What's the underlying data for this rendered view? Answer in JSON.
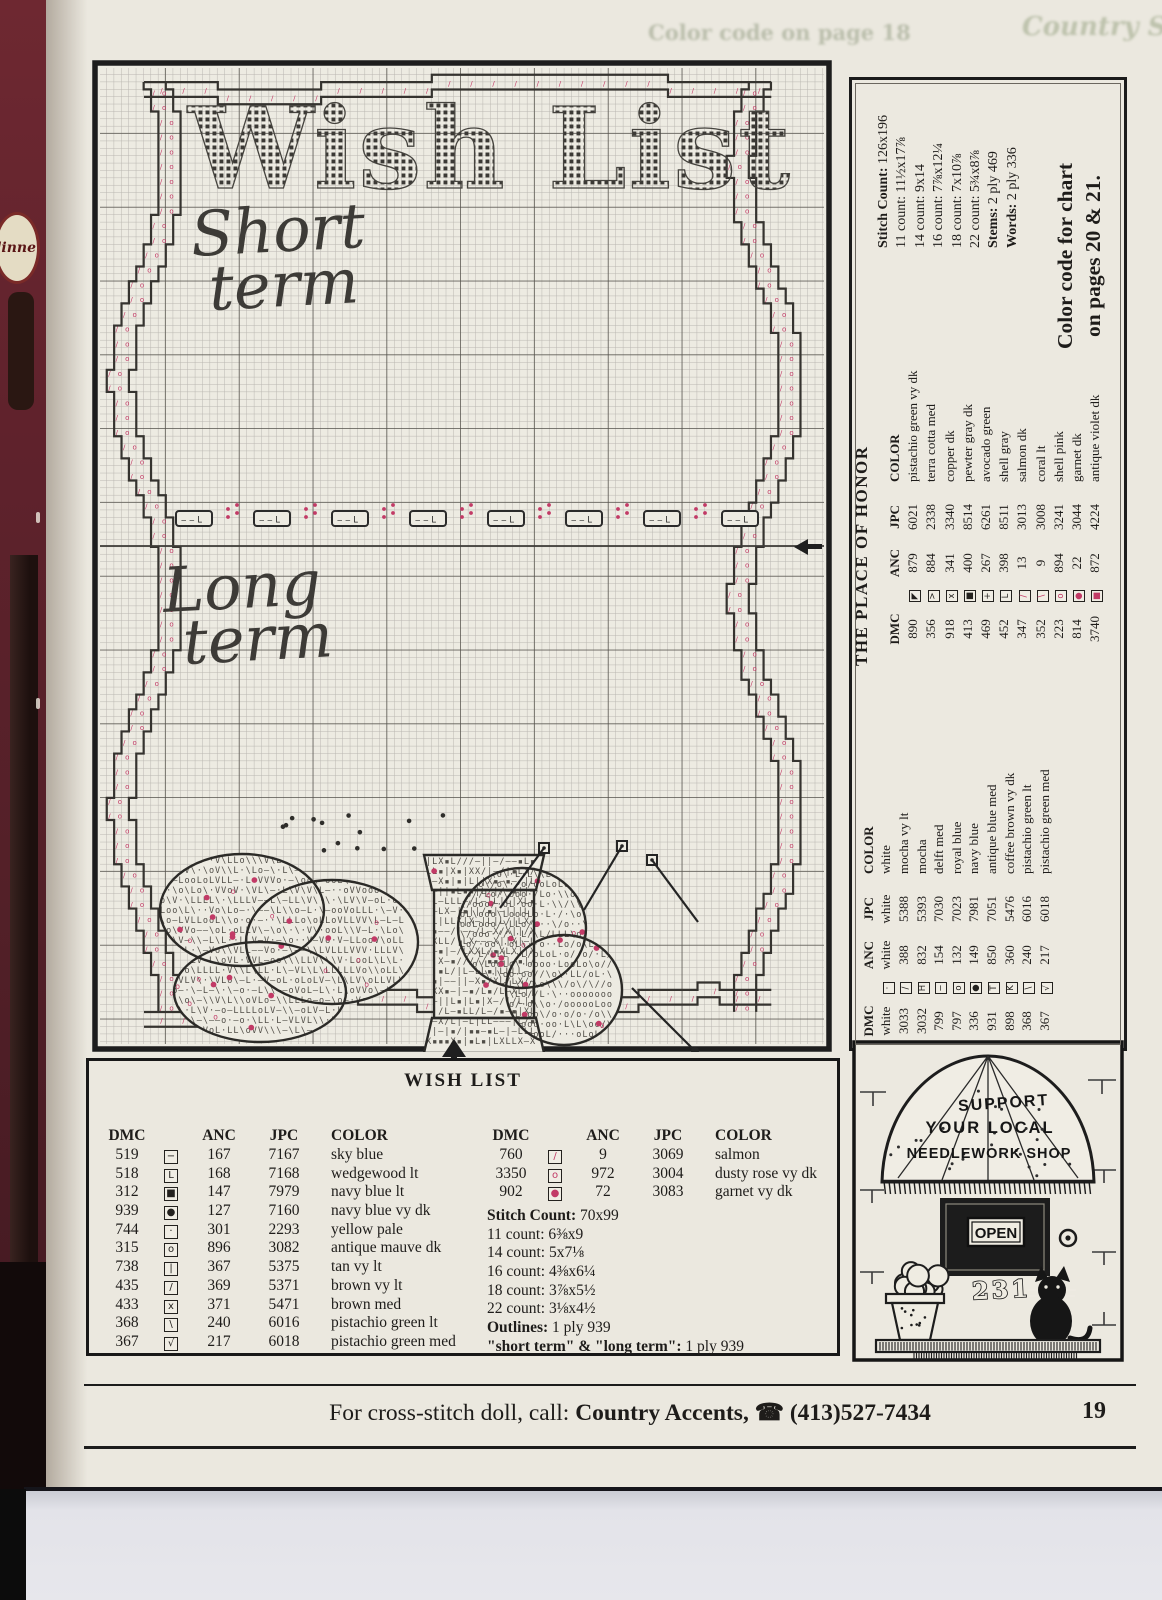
{
  "page": {
    "ghost_left": "Color code on page 18",
    "ghost_right": "Country Sampler",
    "footer": {
      "prefix": "For cross-stitch doll, call:",
      "brand": "Country Accents,",
      "phone_icon": "☎",
      "phone": "(413)527-7434",
      "page_number": "19"
    }
  },
  "side_photo": {
    "label": "dinne"
  },
  "chart": {
    "title": "Wish List",
    "short_line1": "Short",
    "short_line2": "term",
    "long_line1": "Long",
    "long_line2": "term"
  },
  "sidebar": {
    "title": "THE PLACE OF HONOR",
    "note_line1": "Color code for chart",
    "note_line2": "on pages 20 & 21.",
    "counts": [
      {
        "label": "Stitch Count:",
        "value": "126x196",
        "bold": true
      },
      {
        "label": "11 count:",
        "value": "11½x17⅞",
        "bold": false
      },
      {
        "label": "14 count:",
        "value": "9x14",
        "bold": false
      },
      {
        "label": "16 count:",
        "value": "7⅞x12¼",
        "bold": false
      },
      {
        "label": "18 count:",
        "value": "7x10⅞",
        "bold": false
      },
      {
        "label": "22 count:",
        "value": "5¾x8⅞",
        "bold": false
      },
      {
        "label": "Stems:",
        "value": "2 ply 469",
        "bold": true
      },
      {
        "label": "Words:",
        "value": "2 ply 336",
        "bold": true
      }
    ],
    "table1": {
      "headers": [
        "DMC",
        "ANC",
        "JPC",
        "COLOR"
      ],
      "rows": [
        {
          "dmc": "890",
          "sym": "◤",
          "pink": false,
          "anc": "879",
          "jpc": "6021",
          "color": "pistachio green vy dk"
        },
        {
          "dmc": "356",
          "sym": ">",
          "pink": false,
          "anc": "884",
          "jpc": "2338",
          "color": "terra cotta med"
        },
        {
          "dmc": "918",
          "sym": "x",
          "pink": false,
          "anc": "341",
          "jpc": "3340",
          "color": "copper dk"
        },
        {
          "dmc": "413",
          "sym": "■",
          "pink": false,
          "anc": "400",
          "jpc": "8514",
          "color": "pewter gray dk"
        },
        {
          "dmc": "469",
          "sym": "+",
          "pink": false,
          "anc": "267",
          "jpc": "6261",
          "color": "avocado green"
        },
        {
          "dmc": "452",
          "sym": "L",
          "pink": false,
          "anc": "398",
          "jpc": "8511",
          "color": "shell gray"
        },
        {
          "dmc": "347",
          "sym": "/",
          "pink": true,
          "anc": "13",
          "jpc": "3013",
          "color": "salmon dk"
        },
        {
          "dmc": "352",
          "sym": "\\",
          "pink": true,
          "anc": "9",
          "jpc": "3008",
          "color": "coral lt"
        },
        {
          "dmc": "223",
          "sym": "o",
          "pink": true,
          "anc": "894",
          "jpc": "3241",
          "color": "shell pink"
        },
        {
          "dmc": "814",
          "sym": "●",
          "pink": true,
          "anc": "22",
          "jpc": "3044",
          "color": "garnet dk"
        },
        {
          "dmc": "3740",
          "sym": "■",
          "pink": true,
          "anc": "872",
          "jpc": "4224",
          "color": "antique violet dk"
        }
      ]
    },
    "table2": {
      "headers": [
        "DMC",
        "ANC",
        "JPC",
        "COLOR"
      ],
      "rows": [
        {
          "dmc": "white",
          "sym": "·",
          "pink": false,
          "anc": "white",
          "jpc": "white",
          "color": "white"
        },
        {
          "dmc": "3033",
          "sym": "/",
          "pink": false,
          "anc": "388",
          "jpc": "5388",
          "color": "mocha vy lt"
        },
        {
          "dmc": "3032",
          "sym": "H",
          "pink": false,
          "anc": "832",
          "jpc": "5393",
          "color": "mocha"
        },
        {
          "dmc": "799",
          "sym": "−",
          "pink": false,
          "anc": "154",
          "jpc": "7030",
          "color": "delft med"
        },
        {
          "dmc": "797",
          "sym": "o",
          "pink": false,
          "anc": "132",
          "jpc": "7023",
          "color": "royal blue"
        },
        {
          "dmc": "336",
          "sym": "●",
          "pink": false,
          "anc": "149",
          "jpc": "7981",
          "color": "navy blue"
        },
        {
          "dmc": "931",
          "sym": "T",
          "pink": false,
          "anc": "850",
          "jpc": "7051",
          "color": "antique blue med"
        },
        {
          "dmc": "898",
          "sym": "K",
          "pink": false,
          "anc": "360",
          "jpc": "5476",
          "color": "coffee brown vy dk"
        },
        {
          "dmc": "368",
          "sym": "\\",
          "pink": false,
          "anc": "240",
          "jpc": "6016",
          "color": "pistachio green lt"
        },
        {
          "dmc": "367",
          "sym": "√",
          "pink": false,
          "anc": "217",
          "jpc": "6018",
          "color": "pistachio green med"
        }
      ]
    }
  },
  "wish_list_key": {
    "title": "WISH LIST",
    "left": {
      "headers": [
        "DMC",
        "ANC",
        "JPC",
        "COLOR"
      ],
      "rows": [
        {
          "dmc": "519",
          "sym": "−",
          "pink": false,
          "anc": "167",
          "jpc": "7167",
          "color": "sky blue"
        },
        {
          "dmc": "518",
          "sym": "L",
          "pink": false,
          "anc": "168",
          "jpc": "7168",
          "color": "wedgewood lt"
        },
        {
          "dmc": "312",
          "sym": "■",
          "pink": false,
          "anc": "147",
          "jpc": "7979",
          "color": "navy blue lt"
        },
        {
          "dmc": "939",
          "sym": "●",
          "pink": false,
          "anc": "127",
          "jpc": "7160",
          "color": "navy blue vy dk"
        },
        {
          "dmc": "744",
          "sym": "·",
          "pink": false,
          "anc": "301",
          "jpc": "2293",
          "color": "yellow pale"
        },
        {
          "dmc": "315",
          "sym": "o",
          "pink": false,
          "anc": "896",
          "jpc": "3082",
          "color": "antique mauve dk"
        },
        {
          "dmc": "738",
          "sym": "|",
          "pink": false,
          "anc": "367",
          "jpc": "5375",
          "color": "tan vy lt"
        },
        {
          "dmc": "435",
          "sym": "/",
          "pink": false,
          "anc": "369",
          "jpc": "5371",
          "color": "brown vy lt"
        },
        {
          "dmc": "433",
          "sym": "x",
          "pink": false,
          "anc": "371",
          "jpc": "5471",
          "color": "brown med"
        },
        {
          "dmc": "368",
          "sym": "\\",
          "pink": false,
          "anc": "240",
          "jpc": "6016",
          "color": "pistachio green lt"
        },
        {
          "dmc": "367",
          "sym": "√",
          "pink": false,
          "anc": "217",
          "jpc": "6018",
          "color": "pistachio green med"
        }
      ]
    },
    "right": {
      "headers": [
        "DMC",
        "ANC",
        "JPC",
        "COLOR"
      ],
      "rows": [
        {
          "dmc": "760",
          "sym": "/",
          "pink": true,
          "anc": "9",
          "jpc": "3069",
          "color": "salmon"
        },
        {
          "dmc": "3350",
          "sym": "o",
          "pink": true,
          "anc": "972",
          "jpc": "3004",
          "color": "dusty rose vy dk"
        },
        {
          "dmc": "902",
          "sym": "●",
          "pink": true,
          "anc": "72",
          "jpc": "3083",
          "color": "garnet vy dk"
        }
      ]
    },
    "info": [
      {
        "label": "Stitch Count:",
        "value": "70x99",
        "bold": true
      },
      {
        "label": "11 count:",
        "value": "6⅜x9",
        "bold": false
      },
      {
        "label": "14 count:",
        "value": "5x7⅛",
        "bold": false
      },
      {
        "label": "16 count:",
        "value": "4⅜x6¼",
        "bold": false
      },
      {
        "label": "18 count:",
        "value": "3⅞x5½",
        "bold": false
      },
      {
        "label": "22 count:",
        "value": "3⅛x4½",
        "bold": false
      },
      {
        "label": "Outlines:",
        "value": "1 ply 939",
        "bold": true
      },
      {
        "label": "\"short term\" & \"long term\":",
        "value": "1 ply 939",
        "bold": true
      }
    ]
  },
  "shop_ad": {
    "line1": "SUPPORT",
    "line2": "YOUR LOCAL",
    "line3": "NEEDLEWORK SHOP",
    "sign": "OPEN",
    "number": "231"
  },
  "colors": {
    "pink": "#c23a66",
    "ink": "#1e1c1a",
    "cream": "#ebe8df"
  }
}
